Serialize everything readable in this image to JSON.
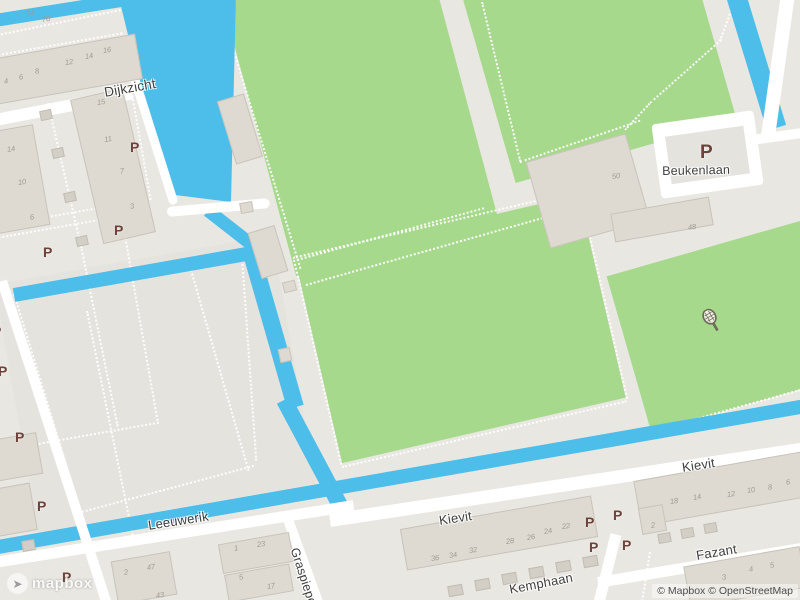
{
  "map": {
    "attribution": "© Mapbox © OpenStreetMap",
    "logo_text": "mapbox",
    "parking_symbol": "P",
    "colors": {
      "background": "#E9E7E2",
      "island_paved": "#E5E3DE",
      "field_green": "#A6D98C",
      "water_blue": "#4DBDEA",
      "road_white": "#FFFFFF",
      "building_fill": "#DEDAD2",
      "building_big_fill": "#DCD8D1",
      "shed_fill": "#D3CFC6",
      "parking_brown": "#6E4238",
      "label_gray": "#3F3F3F",
      "house_number_gray": "#A19B90"
    },
    "street_labels": [
      {
        "id": "dijkzicht",
        "name": "Dijkzicht",
        "x": 103,
        "y": 85,
        "rot": -10,
        "size": 13.5
      },
      {
        "id": "beukenlaan",
        "name": "Beukenlaan",
        "x": 662,
        "y": 164,
        "rot": -1,
        "size": 12.5
      },
      {
        "id": "leeuwerik",
        "name": "Leeuwerik",
        "x": 147,
        "y": 518,
        "rot": -9,
        "size": 13
      },
      {
        "id": "kievit-west",
        "name": "Kievit",
        "x": 438,
        "y": 513,
        "rot": -8.5,
        "size": 13
      },
      {
        "id": "kievit-east",
        "name": "Kievit",
        "x": 681,
        "y": 460,
        "rot": -8.5,
        "size": 13
      },
      {
        "id": "fazant",
        "name": "Fazant",
        "x": 695,
        "y": 548,
        "rot": -9.5,
        "size": 13
      },
      {
        "id": "graspieper",
        "name": "Graspieper",
        "x": 301,
        "y": 546,
        "rot": 72,
        "size": 12.5
      },
      {
        "id": "kemphaan",
        "name": "Kemphaan",
        "x": 508,
        "y": 582,
        "rot": -11,
        "size": 13
      }
    ],
    "parking_markers": [
      {
        "x": 130,
        "y": 140
      },
      {
        "x": 114,
        "y": 223
      },
      {
        "x": 43,
        "y": 245
      },
      {
        "x": -8,
        "y": 324
      },
      {
        "x": -2,
        "y": 364
      },
      {
        "x": 15,
        "y": 430
      },
      {
        "x": 37,
        "y": 499
      },
      {
        "x": 62,
        "y": 570
      },
      {
        "x": 585,
        "y": 515
      },
      {
        "x": 613,
        "y": 508
      },
      {
        "x": 589,
        "y": 540
      },
      {
        "x": 622,
        "y": 538
      },
      {
        "x": 700,
        "y": 143,
        "big": true
      }
    ],
    "house_numbers": [
      {
        "n": "74",
        "x": 30,
        "y": 13
      },
      {
        "n": "76",
        "x": 46,
        "y": 19
      },
      {
        "n": "4",
        "x": 6,
        "y": 81
      },
      {
        "n": "6",
        "x": 21,
        "y": 77
      },
      {
        "n": "8",
        "x": 37,
        "y": 71
      },
      {
        "n": "12",
        "x": 69,
        "y": 62
      },
      {
        "n": "14",
        "x": 89,
        "y": 56
      },
      {
        "n": "16",
        "x": 107,
        "y": 50
      },
      {
        "n": "15",
        "x": 101,
        "y": 102
      },
      {
        "n": "11",
        "x": 108,
        "y": 139
      },
      {
        "n": "7",
        "x": 122,
        "y": 171
      },
      {
        "n": "3",
        "x": 132,
        "y": 206
      },
      {
        "n": "14",
        "x": 11,
        "y": 149
      },
      {
        "n": "10",
        "x": 22,
        "y": 182
      },
      {
        "n": "6",
        "x": 32,
        "y": 217
      },
      {
        "n": "50",
        "x": 616,
        "y": 176
      },
      {
        "n": "48",
        "x": 692,
        "y": 227
      },
      {
        "n": "2",
        "x": 126,
        "y": 572
      },
      {
        "n": "47",
        "x": 151,
        "y": 567
      },
      {
        "n": "43",
        "x": 160,
        "y": 595
      },
      {
        "n": "1",
        "x": 236,
        "y": 548
      },
      {
        "n": "23",
        "x": 261,
        "y": 544
      },
      {
        "n": "5",
        "x": 241,
        "y": 577
      },
      {
        "n": "17",
        "x": 271,
        "y": 586
      },
      {
        "n": "36",
        "x": 435,
        "y": 558
      },
      {
        "n": "34",
        "x": 453,
        "y": 555
      },
      {
        "n": "32",
        "x": 473,
        "y": 550
      },
      {
        "n": "28",
        "x": 510,
        "y": 541
      },
      {
        "n": "26",
        "x": 531,
        "y": 537
      },
      {
        "n": "24",
        "x": 548,
        "y": 531
      },
      {
        "n": "22",
        "x": 566,
        "y": 526
      },
      {
        "n": "2",
        "x": 653,
        "y": 525
      },
      {
        "n": "18",
        "x": 674,
        "y": 501
      },
      {
        "n": "14",
        "x": 697,
        "y": 497
      },
      {
        "n": "12",
        "x": 731,
        "y": 494
      },
      {
        "n": "10",
        "x": 751,
        "y": 490
      },
      {
        "n": "8",
        "x": 770,
        "y": 487
      },
      {
        "n": "6",
        "x": 788,
        "y": 482
      },
      {
        "n": "3",
        "x": 724,
        "y": 577
      },
      {
        "n": "4",
        "x": 751,
        "y": 569
      },
      {
        "n": "5",
        "x": 772,
        "y": 565
      }
    ],
    "poi": [
      {
        "id": "tennis",
        "icon": "tennis-racket-icon",
        "x": 700,
        "y": 308
      }
    ]
  }
}
